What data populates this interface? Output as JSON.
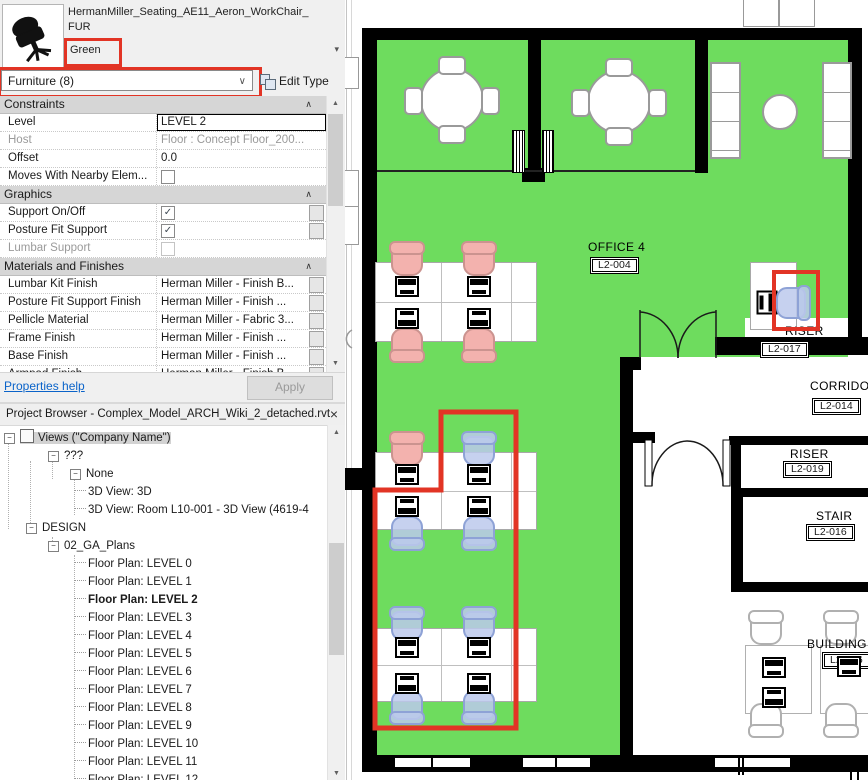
{
  "properties": {
    "family_line1": "HermanMiller_Seating_AE11_Aeron_WorkChair_",
    "family_line2": "FUR",
    "type_name": "Green",
    "category": "Furniture (8)",
    "edit_type_label": "Edit Type",
    "rows": [
      {
        "label": "Constraints"
      },
      {
        "label": "Level",
        "value": "LEVEL 2"
      },
      {
        "label": "Host",
        "value": "Floor : Concept Floor_200..."
      },
      {
        "label": "Offset",
        "value": "0.0"
      },
      {
        "label": "Moves With Nearby Elem...",
        "checked": false
      },
      {
        "label": "Graphics"
      },
      {
        "label": "Support On/Off",
        "checked": true
      },
      {
        "label": "Posture Fit Support",
        "checked": true
      },
      {
        "label": "Lumbar Support",
        "checked": false
      },
      {
        "label": "Materials and Finishes"
      },
      {
        "label": "Lumbar Kit Finish",
        "value": "Herman Miller - Finish B..."
      },
      {
        "label": "Posture Fit Support Finish",
        "value": "Herman Miller - Finish ..."
      },
      {
        "label": "Pellicle Material",
        "value": "Herman Miller - Fabric 3..."
      },
      {
        "label": "Frame Finish",
        "value": "Herman Miller - Finish ..."
      },
      {
        "label": "Base Finish",
        "value": "Herman Miller - Finish ..."
      },
      {
        "label": "Armpad Finish",
        "value": "Herman Miller - Finish B"
      }
    ],
    "help_link": "Properties help",
    "apply_label": "Apply"
  },
  "browser": {
    "title": "Project Browser - Complex_Model_ARCH_Wiki_2_detached.rvt",
    "items": [
      {
        "label": "Views (\"Company Name\")"
      },
      {
        "label": "???"
      },
      {
        "label": "None"
      },
      {
        "label": "3D View: 3D"
      },
      {
        "label": "3D View: Room L10-001 - 3D View (4619-4"
      },
      {
        "label": "DESIGN"
      },
      {
        "label": "02_GA_Plans"
      },
      {
        "label": "Floor Plan: LEVEL 0"
      },
      {
        "label": "Floor Plan: LEVEL 1"
      },
      {
        "label": "Floor Plan: LEVEL 2"
      },
      {
        "label": "Floor Plan: LEVEL 3"
      },
      {
        "label": "Floor Plan: LEVEL 4"
      },
      {
        "label": "Floor Plan: LEVEL 5"
      },
      {
        "label": "Floor Plan: LEVEL 6"
      },
      {
        "label": "Floor Plan: LEVEL 7"
      },
      {
        "label": "Floor Plan: LEVEL 8"
      },
      {
        "label": "Floor Plan: LEVEL 9"
      },
      {
        "label": "Floor Plan: LEVEL 10"
      },
      {
        "label": "Floor Plan: LEVEL 11"
      },
      {
        "label": "Floor Plan: LEVEL 12"
      }
    ]
  },
  "plan": {
    "rooms": {
      "office": {
        "name": "OFFICE 4",
        "tag": "L2-004"
      },
      "riser1": {
        "name": "RISER",
        "tag": "L2-017"
      },
      "corridor": {
        "name": "CORRIDOR",
        "tag": "L2-014"
      },
      "riser2": {
        "name": "RISER",
        "tag": "L2-019"
      },
      "stair": {
        "name": "STAIR",
        "tag": "L2-016"
      },
      "building": {
        "name": "BUILDING",
        "tag": "L2-006"
      }
    },
    "colors": {
      "room_highlight": "#6edc5e",
      "selection_outline": "#e23425",
      "chair_pink": "#f3b2ae",
      "chair_selected": "#bcc9ec"
    }
  }
}
